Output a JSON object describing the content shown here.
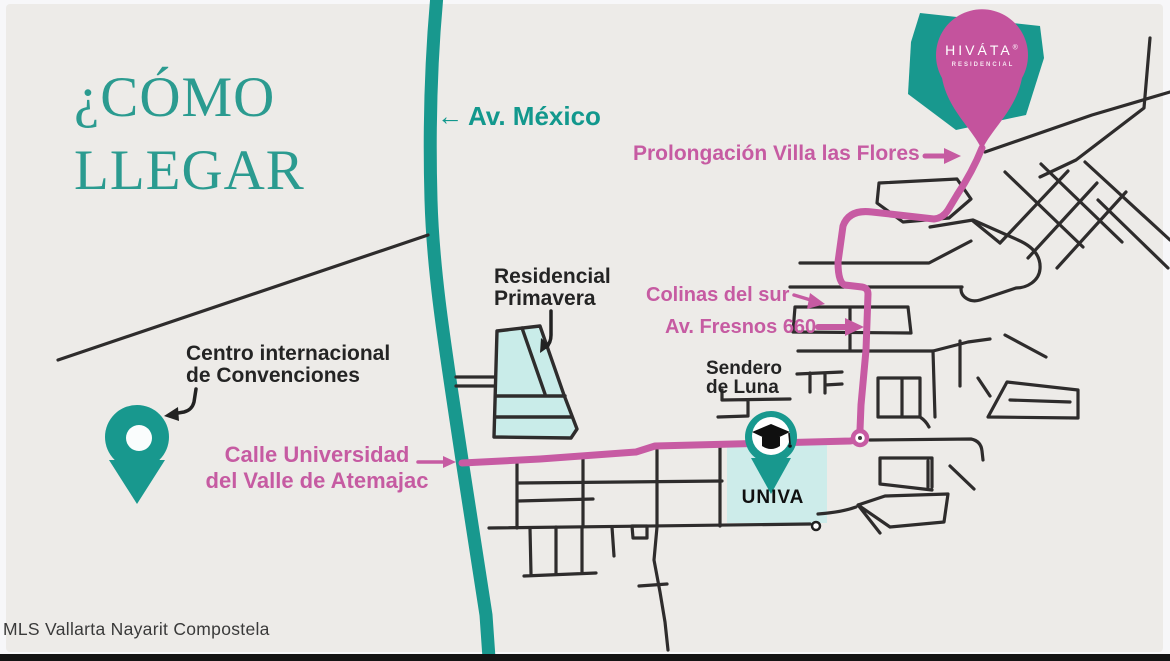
{
  "title": {
    "line1": "¿CÓMO",
    "line2": "LLEGAR"
  },
  "watermark": "MLS Vallarta Nayarit Compostela",
  "brand": {
    "name": "HIVÁTA",
    "registered_mark": "®",
    "subtitle": "RESIDENCIAL"
  },
  "streets": {
    "av_mexico_arrow": "←",
    "av_mexico": "Av. México",
    "prolongacion_villa_las_flores": "Prolongación Villa las Flores",
    "colinas_del_sur": "Colinas del sur",
    "av_fresnos": "Av. Fresnos 660",
    "sendero_de_luna": {
      "line1": "Sendero",
      "line2": "de Luna"
    },
    "calle_universidad": {
      "line1": "Calle Universidad",
      "line2": "del Valle de Atemajac"
    }
  },
  "places": {
    "residencial_primavera": {
      "line1": "Residencial",
      "line2": "Primavera"
    },
    "centro_convenciones": {
      "line1": "Centro internacional",
      "line2": "de Convenciones"
    },
    "univa": "UNIVA"
  },
  "colors": {
    "background": "#edebe8",
    "teal": "#18988e",
    "pink_route": "#c75ba3",
    "pink_pin": "#c4539d",
    "pink_text": "#c65ba2",
    "light_cyan": "#c9ece9",
    "road_black": "#2e2c2c",
    "title_teal": "#2b9b90"
  }
}
